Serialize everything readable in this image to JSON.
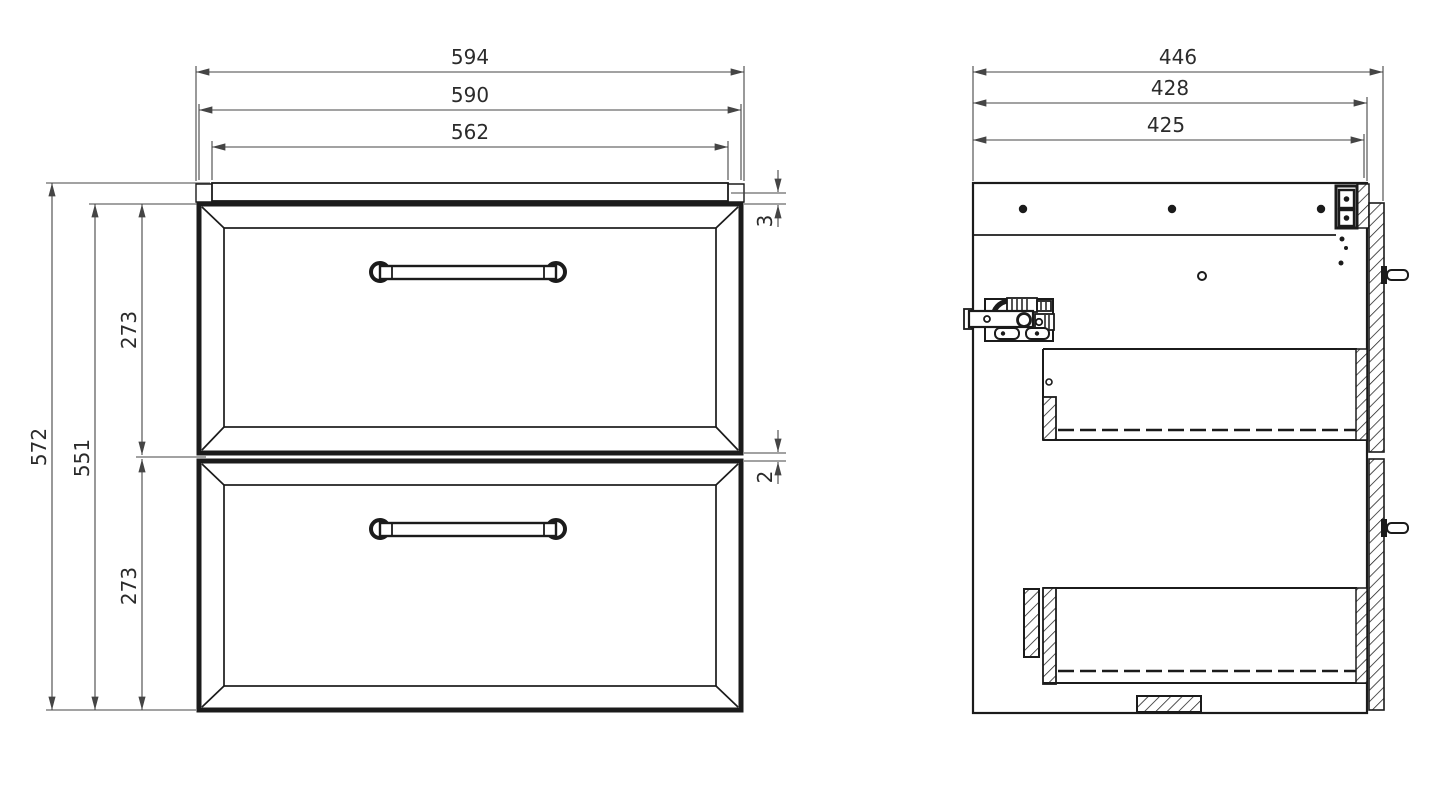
{
  "front_view": {
    "dims": {
      "overall_width": "594",
      "drawer_fronts_width": "590",
      "top_panel_width": "562",
      "overall_height": "572",
      "drawer_fronts_height": "551",
      "upper_drawer_height": "273",
      "lower_drawer_height": "273",
      "top_reveal": "3",
      "drawer_gap": "2"
    }
  },
  "side_view": {
    "dims": {
      "overall_depth": "446",
      "body_depth": "428",
      "top_rail_depth": "425"
    }
  },
  "style": {
    "object_line_color": "#1b1b1b",
    "dimension_line_color": "#454545",
    "background_color": "#ffffff"
  }
}
